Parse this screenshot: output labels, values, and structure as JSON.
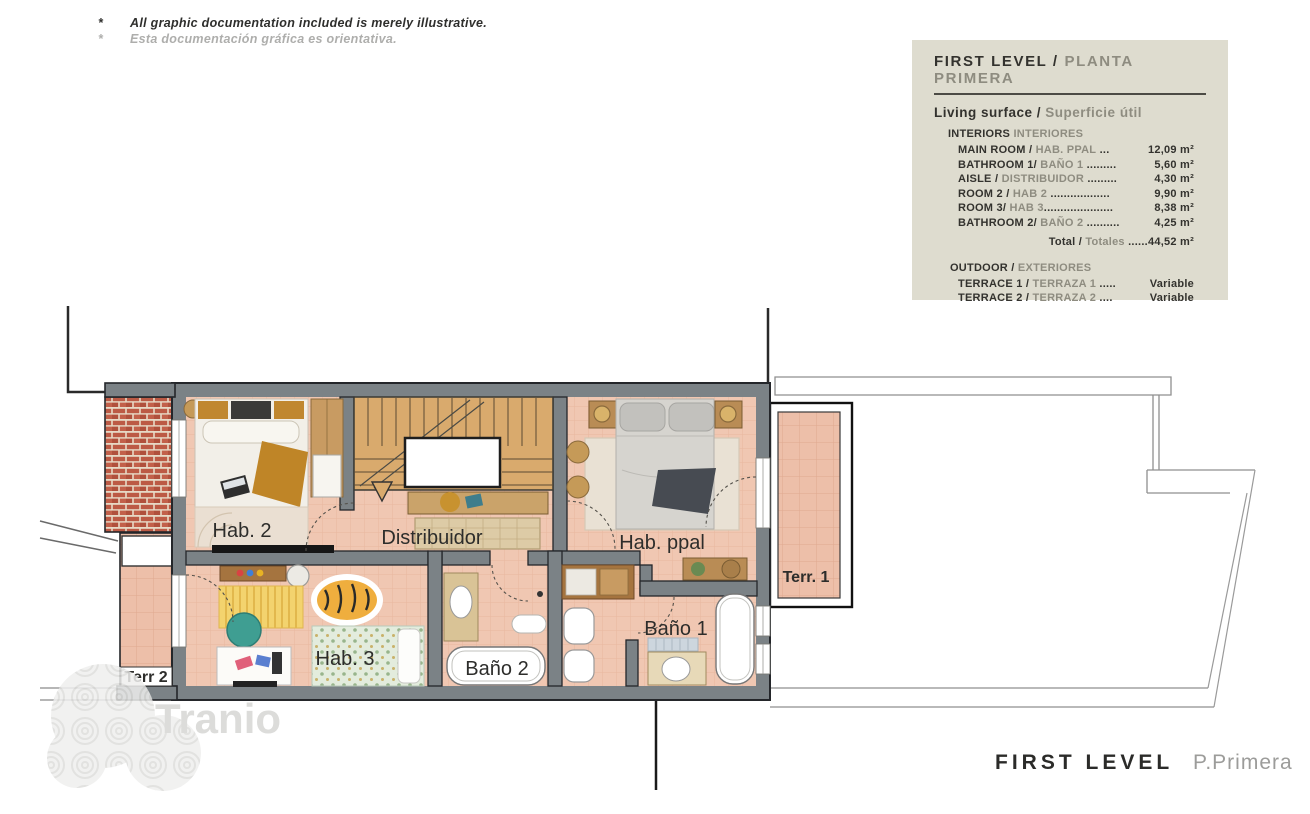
{
  "disclaimer": {
    "marker": "*",
    "line1": "All graphic documentation included is merely illustrative.",
    "line2": "Esta documentación gráfica es orientativa."
  },
  "legend": {
    "title_en": "FIRST LEVEL /",
    "title_es": "PLANTA PRIMERA",
    "subtitle_en": "Living surface /",
    "subtitle_es": "Superficie útil",
    "interiors_heading_en": "INTERIORS",
    "interiors_heading_es": "INTERIORES",
    "rows": [
      {
        "en": "MAIN ROOM / ",
        "es": "HAB. PPAL",
        "dots": " ... ",
        "value": "12,09 m²"
      },
      {
        "en": "BATHROOM 1/ ",
        "es": "BAÑO 1",
        "dots": " ......... ",
        "value": "5,60 m²"
      },
      {
        "en": "AISLE / ",
        "es": "DISTRIBUIDOR",
        "dots": " ......... ",
        "value": "4,30 m²"
      },
      {
        "en": "ROOM 2 / ",
        "es": "HAB 2",
        "dots": " .................. ",
        "value": "9,90 m²"
      },
      {
        "en": "ROOM 3/ ",
        "es": "HAB 3",
        "dots": ".....................",
        "value": "8,38 m²"
      },
      {
        "en": "BATHROOM 2/ ",
        "es": "BAÑO 2",
        "dots": " .......... ",
        "value": "4,25 m²"
      }
    ],
    "total_en": "Total / ",
    "total_es": "Totales",
    "total_dots": " ......",
    "total_value": "44,52 m²",
    "outdoor_heading_en": "OUTDOOR /",
    "outdoor_heading_es": "EXTERIORES",
    "outdoor_rows": [
      {
        "en": "TERRACE 1 / ",
        "es": "TERRAZA 1",
        "dots": " ..... ",
        "value": "Variable"
      },
      {
        "en": "TERRACE 2 / ",
        "es": "TERRAZA 2",
        "dots": " .... ",
        "value": "Variable"
      }
    ]
  },
  "plan": {
    "labels": {
      "hab2": "Hab. 2",
      "distribuidor": "Distribuidor",
      "hab_ppal": "Hab. ppal",
      "hab3": "Hab. 3",
      "bano2": "Baño 2",
      "bano1": "Baño 1",
      "terr1": "Terr. 1",
      "terr2": "Terr 2"
    }
  },
  "footer": {
    "title_en": "FIRST LEVEL",
    "title_es": "P.Primera"
  },
  "watermark": {
    "text": "Tranio"
  },
  "colors": {
    "legend_bg": "#dedccf",
    "wall": "#7b8286",
    "wall_outline": "#24262a",
    "floor": "#f0c7b2",
    "terrace": "#edbfa9",
    "brick": "#bc5a45",
    "text_dark": "#33322e",
    "text_gray": "#8e8c80",
    "stair_wood": "#d9aa6d"
  }
}
